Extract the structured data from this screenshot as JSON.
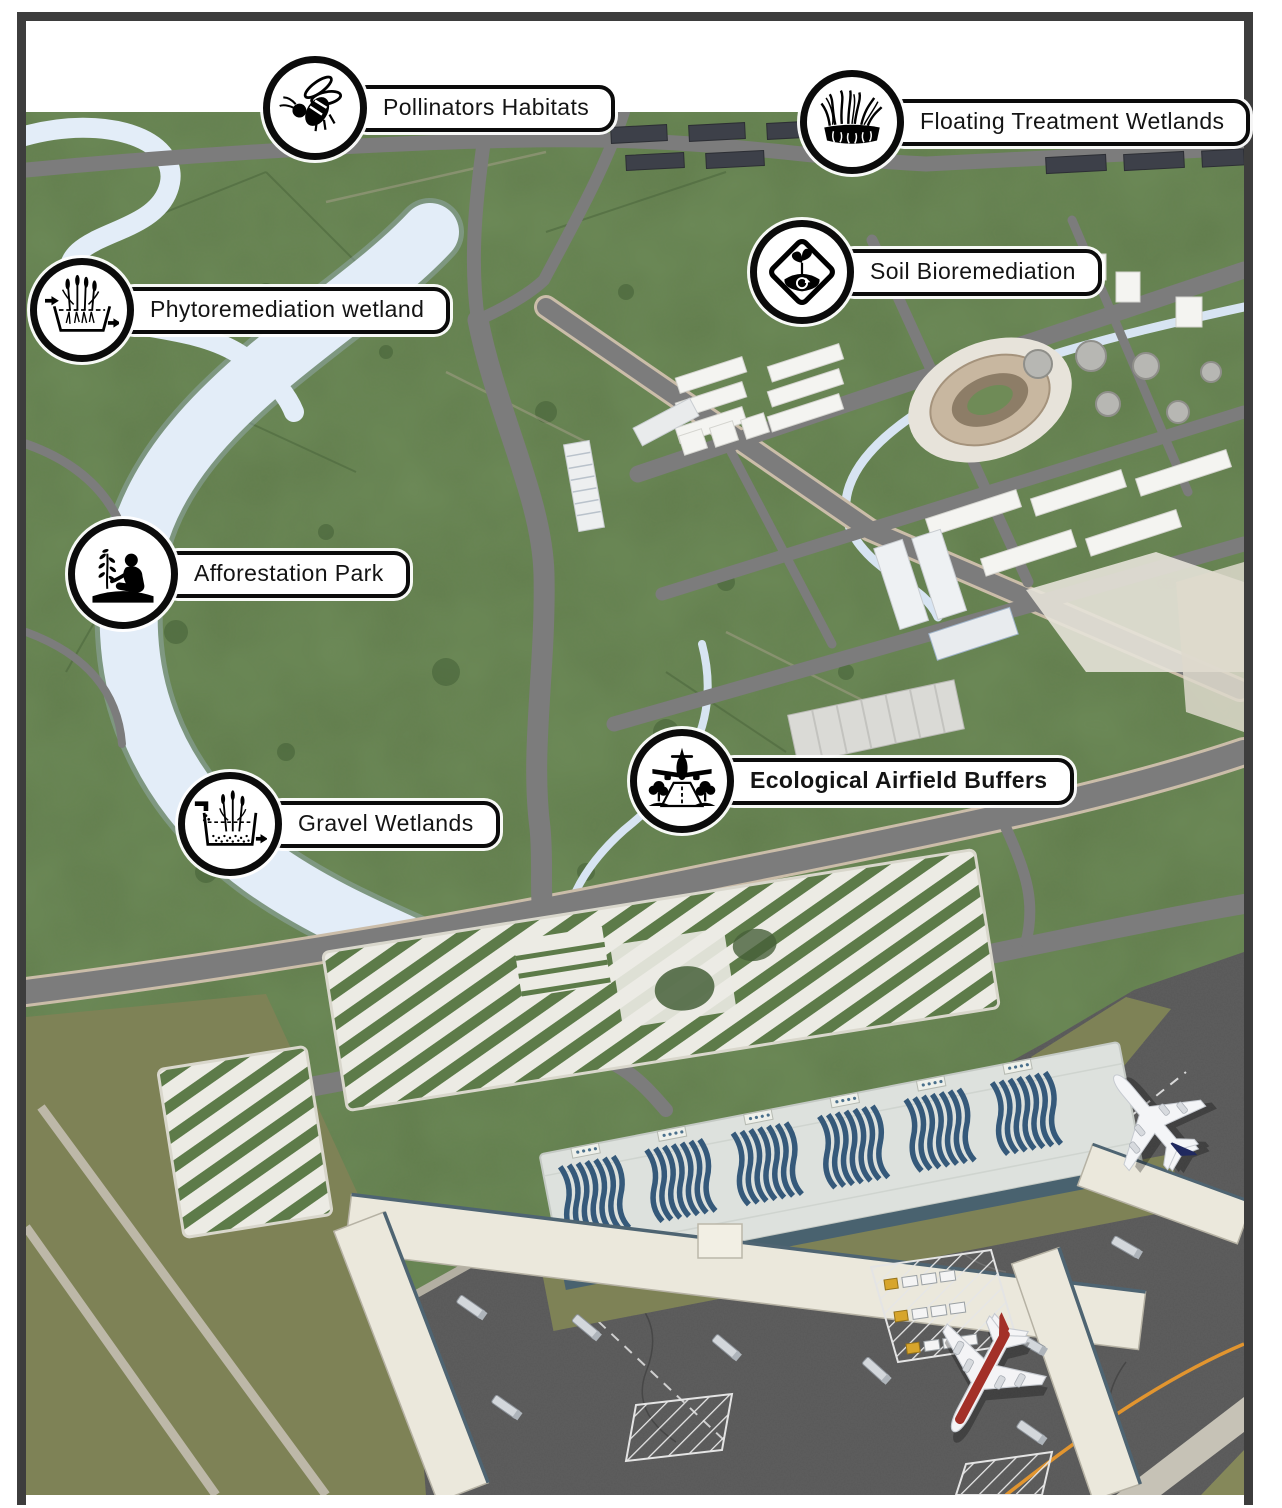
{
  "figure": {
    "type": "aerial-masterplan-rendering",
    "subject": "airport and surrounding landscape with ecological infrastructure callouts"
  },
  "callouts": [
    {
      "id": "pollinators",
      "label": "Pollinators Habitats",
      "icon": "bee-icon",
      "emphasis": false
    },
    {
      "id": "floating",
      "label": "Floating Treatment Wetlands",
      "icon": "floating-wetland-icon",
      "emphasis": false
    },
    {
      "id": "phyto",
      "label": "Phytoremediation wetland",
      "icon": "phytoremediation-icon",
      "emphasis": false
    },
    {
      "id": "soil",
      "label": "Soil Bioremediation",
      "icon": "soil-bioremediation-icon",
      "emphasis": false
    },
    {
      "id": "afforestation",
      "label": "Afforestation Park",
      "icon": "tree-planting-icon",
      "emphasis": false
    },
    {
      "id": "gravel",
      "label": "Gravel Wetlands",
      "icon": "gravel-wetland-icon",
      "emphasis": false
    },
    {
      "id": "ecological",
      "label": "Ecological Airfield Buffers",
      "icon": "airfield-buffer-icon",
      "emphasis": true
    }
  ],
  "palette": {
    "terrain_green": "#617d4c",
    "river_blue": "#e3edf8",
    "road_gray": "#7c7c7c",
    "apron_asphalt": "#585858",
    "buffer_olive": "#7e8256",
    "parking_deck": "#ecebe4",
    "solar_panel_blue": "#35597a",
    "warehouse_dark": "#3d4049",
    "taxi_line_orange": "#e2952f",
    "label_background": "#ffffff",
    "label_border": "#0b0b0b",
    "frame_border": "#3d3d3d",
    "tail_navy": "#20295f",
    "airline_red": "#a33028"
  }
}
